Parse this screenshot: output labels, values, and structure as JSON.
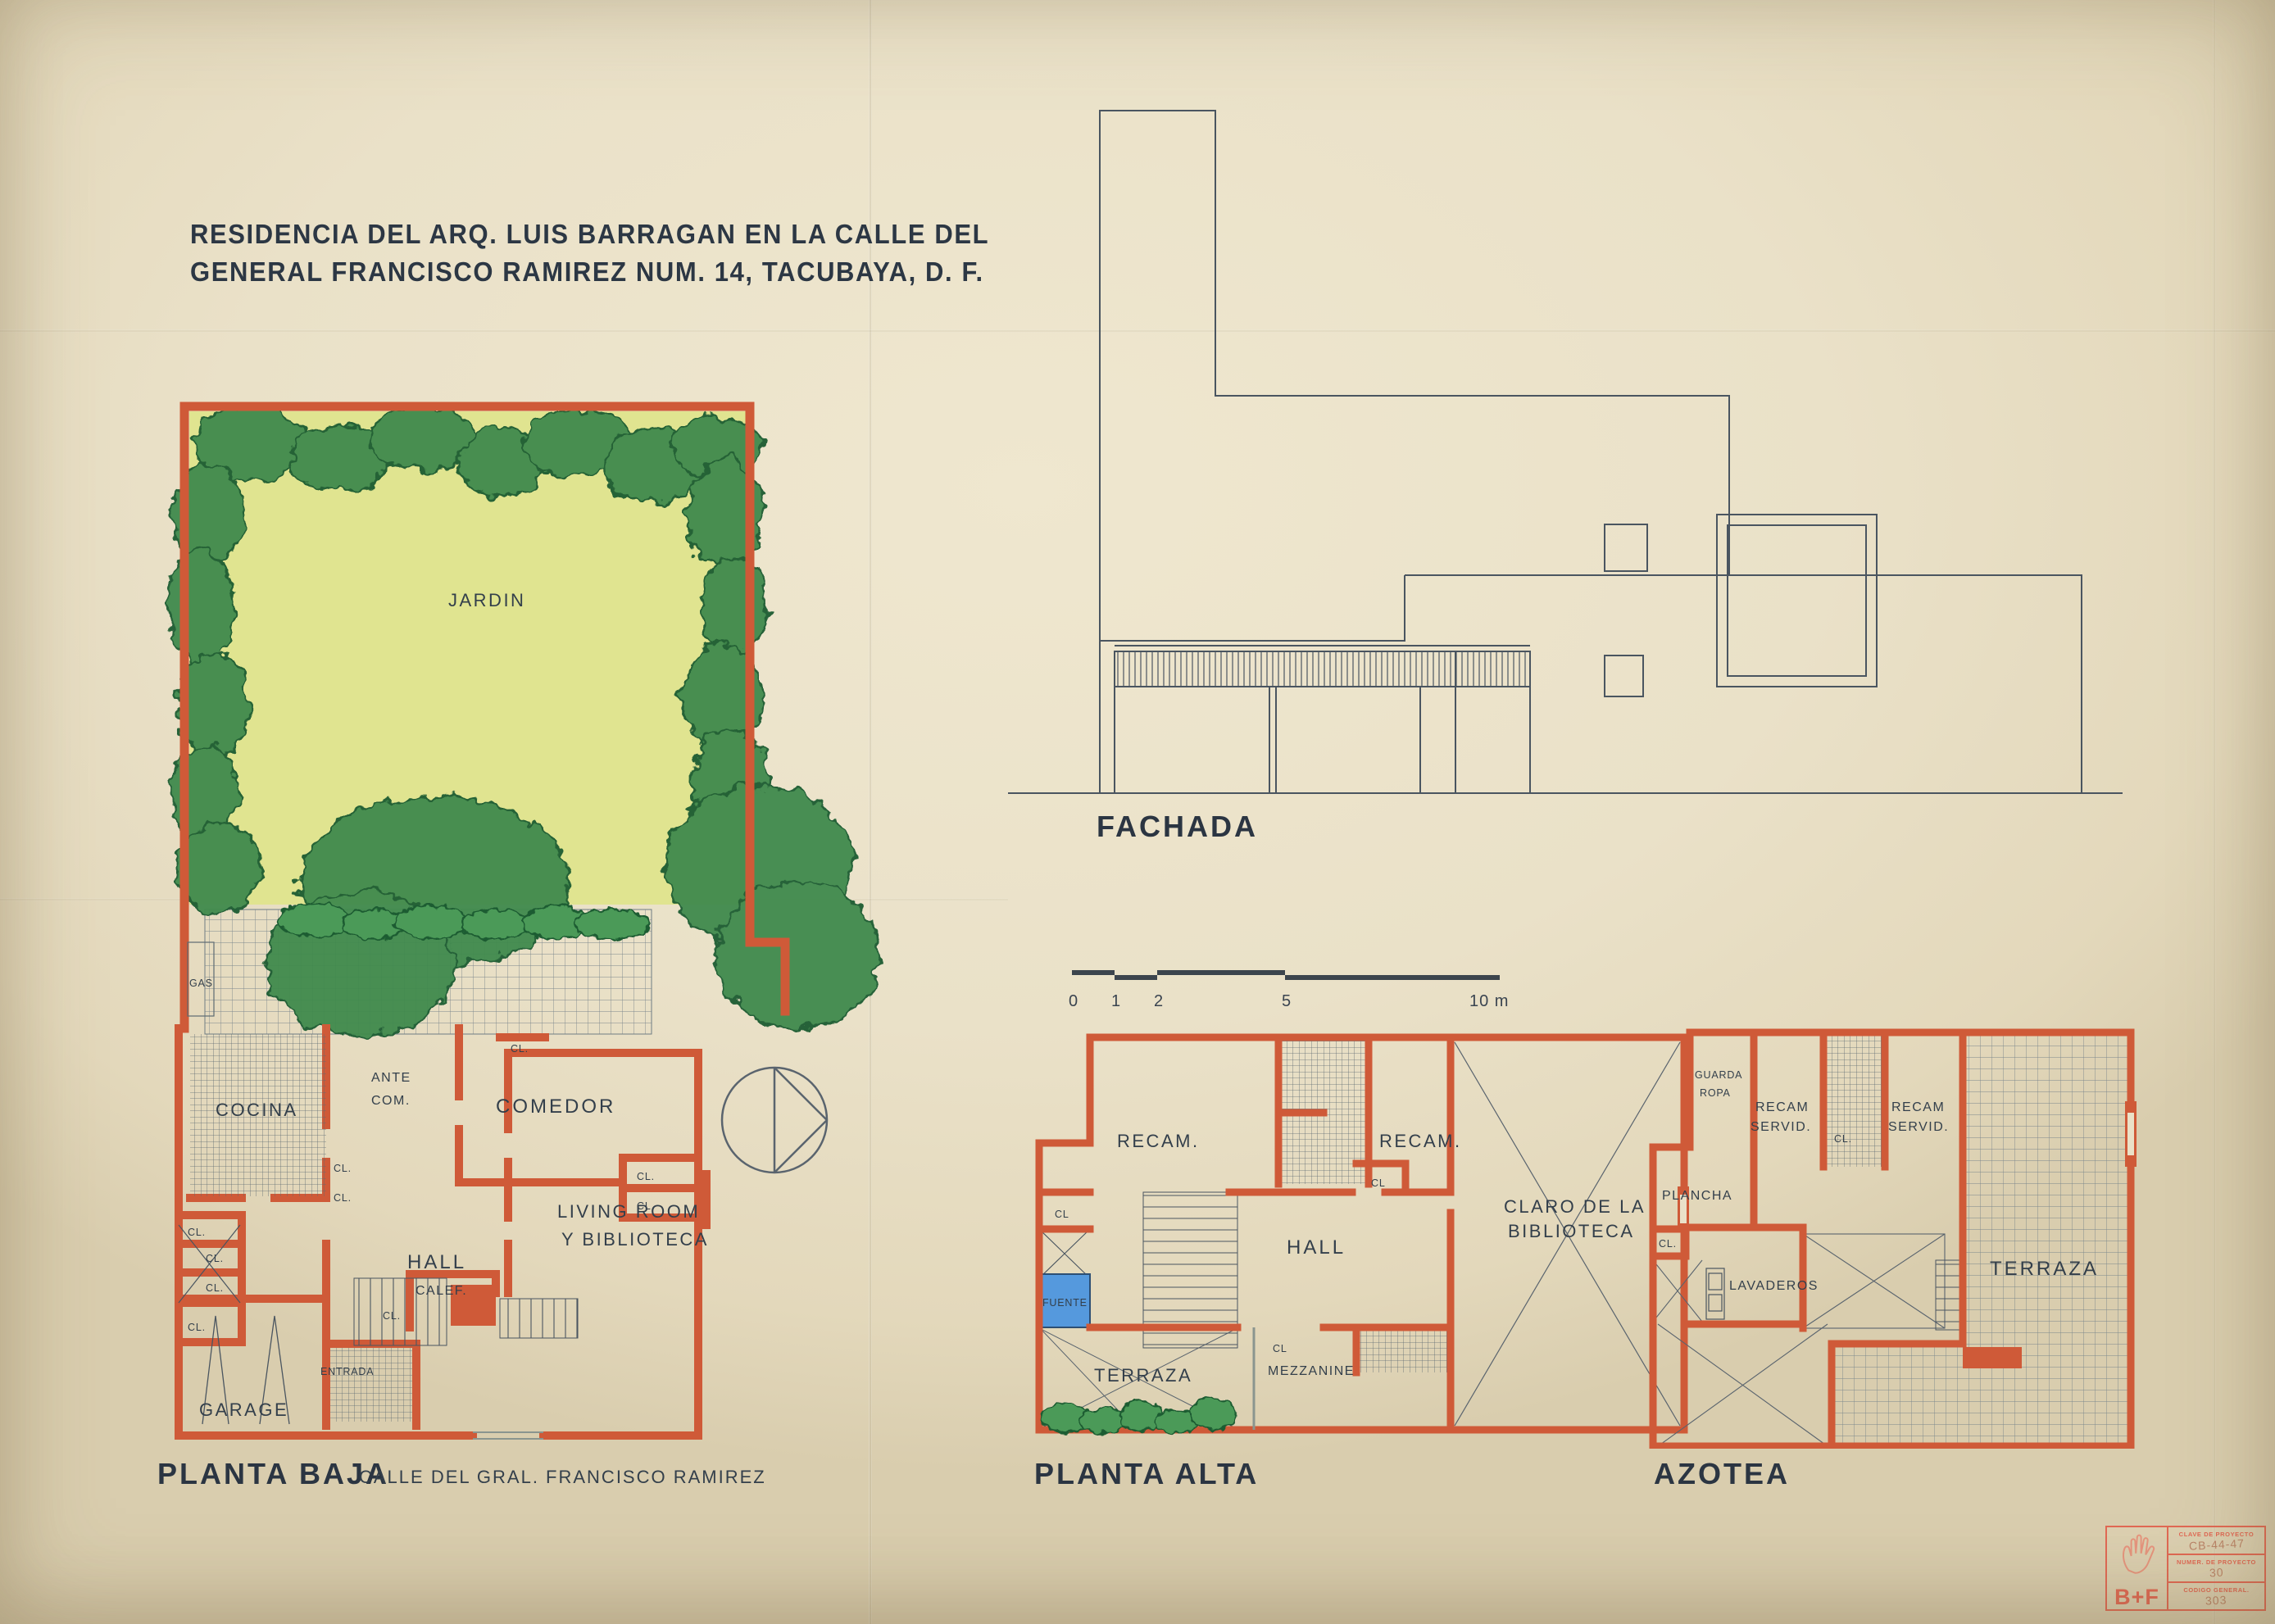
{
  "title": {
    "line1": "RESIDENCIA DEL ARQ. LUIS BARRAGAN EN LA CALLE DEL",
    "line2": "GENERAL FRANCISCO RAMIREZ NUM. 14, TACUBAYA, D. F."
  },
  "facade": {
    "label": "FACHADA"
  },
  "scale_bar": {
    "ticks": [
      "0",
      "1",
      "2",
      "5",
      "10 m"
    ]
  },
  "planta_baja": {
    "label": "PLANTA BAJA",
    "street": "CALLE DEL GRAL. FRANCISCO RAMIREZ",
    "rooms": {
      "jardin": "JARDIN",
      "gas": "GAS",
      "cocina": "COCINA",
      "ante_com_1": "ANTE",
      "ante_com_2": "COM.",
      "comedor": "COMEDOR",
      "hall": "HALL",
      "living_1": "LIVING ROOM",
      "living_2": "Y BIBLIOTECA",
      "garage": "GARAGE",
      "entrada": "ENTRADA",
      "calef": "CALEF.",
      "closet": "CL."
    }
  },
  "planta_alta": {
    "label": "PLANTA ALTA",
    "rooms": {
      "recam": "RECAM.",
      "hall": "HALL",
      "claro_1": "CLARO DE LA",
      "claro_2": "BIBLIOTECA",
      "fuente": "FUENTE",
      "terraza": "TERRAZA",
      "mezzanine": "MEZZANINE",
      "closet": "CL"
    }
  },
  "azotea": {
    "label": "AZOTEA",
    "rooms": {
      "guarda_1": "GUARDA",
      "guarda_2": "ROPA",
      "recam_servid_1": "RECAM",
      "recam_servid_2": "SERVID.",
      "plancha": "PLANCHA",
      "lavaderos": "LAVADEROS",
      "terraza": "TERRAZA",
      "closet": "CL."
    }
  },
  "stamp": {
    "logo": "B+F",
    "rows": [
      {
        "label": "CLAVE DE PROYECTO",
        "value": "CB-44-47"
      },
      {
        "label": "NUMER. DE PROYECTO",
        "value": "30"
      },
      {
        "label": "CODIGO GENERAL.",
        "value": "303"
      }
    ]
  },
  "colors": {
    "paper": "#eae1c8",
    "wall_red": "#cf5a38",
    "ink": "#44505b",
    "garden_yellow": "#dfe390",
    "foliage_green": "#3f8a4e",
    "water_blue": "#4f97dd",
    "stamp_red": "#e2614d"
  }
}
